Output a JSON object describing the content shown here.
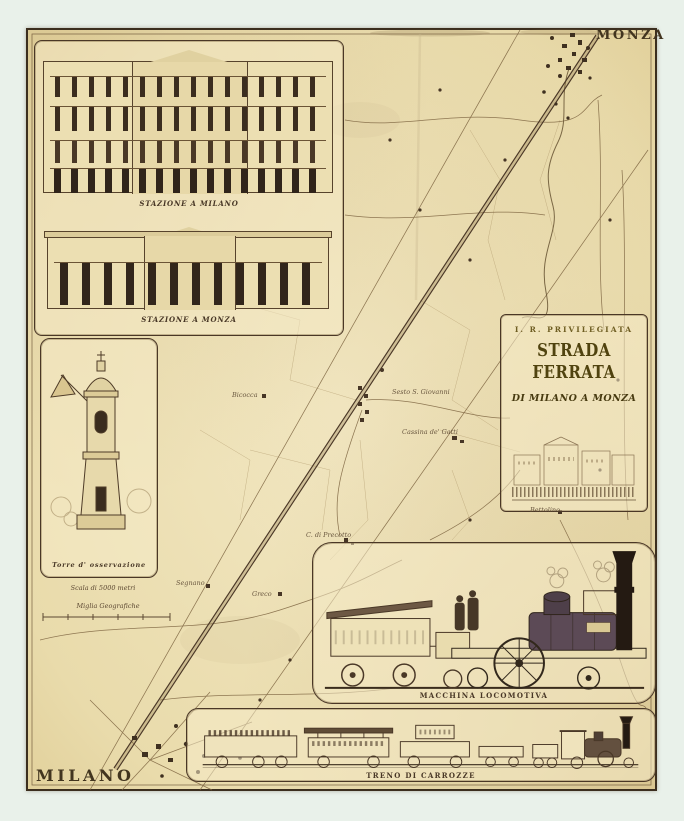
{
  "cities": {
    "monza": "MONZA",
    "milano": "MILANO"
  },
  "cartouche": {
    "line1": "I. R. PRIVILEGIATA",
    "line2": "STRADA FERRATA",
    "line3": "DI MILANO A MONZA"
  },
  "captions": {
    "station_milano": "STAZIONE A MILANO",
    "station_monza": "STAZIONE A MONZA",
    "tower": "Torre d' osservazione",
    "locomotive": "MACCHINA LOCOMOTIVA",
    "train": "TRENO DI CARROZZE"
  },
  "scale": {
    "metri": "Scala di 5000 metri",
    "miglia": "Miglia Geografiche"
  },
  "places": {
    "sesto": "Sesto S. Giovanni",
    "cassina": "Cassina de' Gatti",
    "precotto": "C. di Precotto",
    "bicocca": "Bicocca",
    "segnano": "Segnano",
    "greco": "Greco",
    "bettolino": "Bettolino"
  },
  "colors": {
    "paper": "#ecdfb4",
    "ink": "#4a3726",
    "ink_light": "#8a7148",
    "title_ink": "#50430f",
    "scan_background": "#e9f1ea"
  }
}
